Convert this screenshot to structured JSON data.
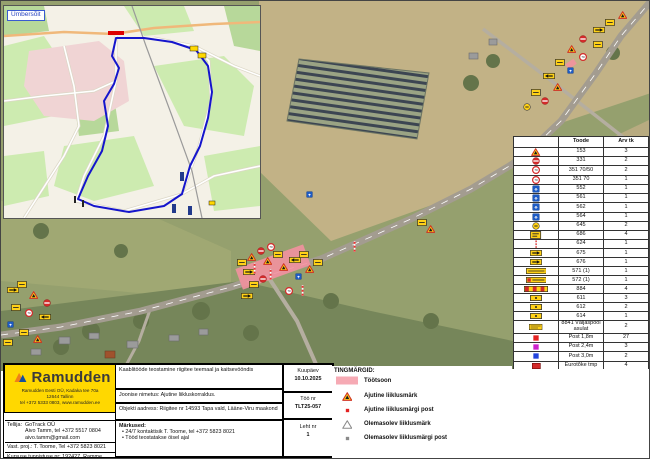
{
  "inset": {
    "label": "Ümbersõit"
  },
  "sign_table": {
    "headers": [
      "",
      "Toode",
      "Arv tk"
    ],
    "rows": [
      {
        "icon": "tri",
        "code": "153",
        "qty": "3"
      },
      {
        "icon": "noentry",
        "code": "331",
        "qty": "2"
      },
      {
        "icon": "speed",
        "code": "351 70/50",
        "qty": "2"
      },
      {
        "icon": "speed",
        "code": "351 70",
        "qty": "1"
      },
      {
        "icon": "blue",
        "code": "552",
        "qty": "1"
      },
      {
        "icon": "blue",
        "code": "561",
        "qty": "1"
      },
      {
        "icon": "blue",
        "code": "562",
        "qty": "1"
      },
      {
        "icon": "blue",
        "code": "564",
        "qty": "1"
      },
      {
        "icon": "yc",
        "code": "645",
        "qty": "2"
      },
      {
        "icon": "yr686",
        "code": "686",
        "qty": "4"
      },
      {
        "icon": "post",
        "code": "624",
        "qty": "1"
      },
      {
        "icon": "arrR",
        "code": "675",
        "qty": "1"
      },
      {
        "icon": "arrL",
        "code": "676",
        "qty": "1"
      },
      {
        "icon": "plate",
        "code": "571 (1)",
        "qty": "1"
      },
      {
        "icon": "plate2",
        "code": "572 (1)",
        "qty": "1"
      },
      {
        "icon": "stripes",
        "code": "884",
        "qty": "4"
      },
      {
        "icon": "sy",
        "code": "611",
        "qty": "3"
      },
      {
        "icon": "sy",
        "code": "612",
        "qty": "2"
      },
      {
        "icon": "sy",
        "code": "614",
        "qty": "1"
      },
      {
        "icon": "bigplate",
        "code": "8841 Väljaspool asulat",
        "qty": "2"
      },
      {
        "icon": "dot-red",
        "code": "Post 1,8m",
        "qty": "27"
      },
      {
        "icon": "dot-magenta",
        "code": "Post 2,4m",
        "qty": "3"
      },
      {
        "icon": "dot-blue",
        "code": "Post 3,0m",
        "qty": "2"
      },
      {
        "icon": "redsq",
        "code": "Eurotõke tmp",
        "qty": "4"
      }
    ]
  },
  "symbols": {
    "title": "TINGMÄRGID:",
    "items": [
      {
        "icon": "zone",
        "label": "Töötsoon"
      },
      {
        "icon": "tri",
        "label": "Ajutine liiklusmärk"
      },
      {
        "icon": "dot-red",
        "label": "Ajutine liiklusmärgi post"
      },
      {
        "icon": "tri-gray",
        "label": "Olemasolev liiklusmärk"
      },
      {
        "icon": "dot-gray",
        "label": "Olemasolev liiklusmärgi post"
      }
    ]
  },
  "titleblock": {
    "brand": "Ramudden",
    "company_lines": [
      "Ramudden Eesti OÜ, Kadaka tee 70a",
      "12644 Tallinn",
      "tel +372 5333 0803, www.ramudden.ee"
    ],
    "tellija_label": "Tellija:",
    "tellija_lines": [
      "GoTrack OÜ",
      "Aivo Tamm, tel +372 5517 0804",
      "aivo.tamm@gmail.com"
    ],
    "vastproj": "Vast. proj.: T. Toome, Tel +372 5823 8021",
    "kursus": "Kursuse tunnistuse nr: 192427, Ramme",
    "tegevusluba": "Tegevusluba nr ELK00023",
    "desc": "Kaablitööde teostamine riigitee teemaal ja kaitsevööndis",
    "joonis": "Joonise nimetus: Ajutine liikluskorraldus.",
    "aadress": "Objekti aadress: Riigitee nr 14593 Tapa vald, Lääne-Viru maakond",
    "markused_title": "Märkused:",
    "markused": [
      "24/7 kontaktisik T. Toome, tel +372 5823 8021",
      "Tööd teostatakse öisel ajal"
    ],
    "kuupaev_label": "Kuupäev",
    "kuupaev": "10.10.2025",
    "toonr_label": "Töö nr",
    "toonr": "TLT25-057",
    "leht_label": "Leht nr",
    "leht": "1"
  },
  "map": {
    "work_zone_color": "#f2919e",
    "markers": [
      {
        "x": 617,
        "y": 10,
        "t": "tri"
      },
      {
        "x": 604,
        "y": 18,
        "t": "yr"
      },
      {
        "x": 592,
        "y": 26,
        "t": "arrR"
      },
      {
        "x": 578,
        "y": 34,
        "t": "noentry"
      },
      {
        "x": 592,
        "y": 40,
        "t": "yr"
      },
      {
        "x": 566,
        "y": 44,
        "t": "tri"
      },
      {
        "x": 578,
        "y": 52,
        "t": "speed"
      },
      {
        "x": 554,
        "y": 58,
        "t": "yr"
      },
      {
        "x": 566,
        "y": 66,
        "t": "blue"
      },
      {
        "x": 542,
        "y": 72,
        "t": "arrL"
      },
      {
        "x": 552,
        "y": 82,
        "t": "tri"
      },
      {
        "x": 530,
        "y": 88,
        "t": "yr"
      },
      {
        "x": 540,
        "y": 96,
        "t": "noentry"
      },
      {
        "x": 522,
        "y": 102,
        "t": "yc"
      },
      {
        "x": 236,
        "y": 258,
        "t": "yr"
      },
      {
        "x": 246,
        "y": 252,
        "t": "tri"
      },
      {
        "x": 256,
        "y": 246,
        "t": "noentry"
      },
      {
        "x": 266,
        "y": 242,
        "t": "speed"
      },
      {
        "x": 242,
        "y": 268,
        "t": "arrR"
      },
      {
        "x": 252,
        "y": 262,
        "t": "post"
      },
      {
        "x": 262,
        "y": 256,
        "t": "tri"
      },
      {
        "x": 272,
        "y": 250,
        "t": "yr"
      },
      {
        "x": 248,
        "y": 280,
        "t": "yr"
      },
      {
        "x": 258,
        "y": 274,
        "t": "noentry"
      },
      {
        "x": 268,
        "y": 268,
        "t": "post"
      },
      {
        "x": 278,
        "y": 262,
        "t": "tri"
      },
      {
        "x": 288,
        "y": 256,
        "t": "arrL"
      },
      {
        "x": 298,
        "y": 250,
        "t": "yr"
      },
      {
        "x": 294,
        "y": 272,
        "t": "blue"
      },
      {
        "x": 304,
        "y": 264,
        "t": "tri"
      },
      {
        "x": 312,
        "y": 258,
        "t": "yr"
      },
      {
        "x": 240,
        "y": 292,
        "t": "arrR"
      },
      {
        "x": 300,
        "y": 284,
        "t": "post"
      },
      {
        "x": 284,
        "y": 286,
        "t": "speed"
      },
      {
        "x": 6,
        "y": 286,
        "t": "arrR"
      },
      {
        "x": 16,
        "y": 280,
        "t": "yr"
      },
      {
        "x": 28,
        "y": 290,
        "t": "tri"
      },
      {
        "x": 42,
        "y": 298,
        "t": "noentry"
      },
      {
        "x": 10,
        "y": 303,
        "t": "yr"
      },
      {
        "x": 24,
        "y": 308,
        "t": "speed"
      },
      {
        "x": 38,
        "y": 313,
        "t": "arrL"
      },
      {
        "x": 6,
        "y": 320,
        "t": "blue"
      },
      {
        "x": 18,
        "y": 328,
        "t": "yr"
      },
      {
        "x": 32,
        "y": 334,
        "t": "tri"
      },
      {
        "x": 2,
        "y": 338,
        "t": "yr"
      },
      {
        "x": 416,
        "y": 218,
        "t": "yr"
      },
      {
        "x": 425,
        "y": 224,
        "t": "tri"
      },
      {
        "x": 305,
        "y": 190,
        "t": "blue"
      },
      {
        "x": 352,
        "y": 240,
        "t": "post"
      }
    ]
  }
}
